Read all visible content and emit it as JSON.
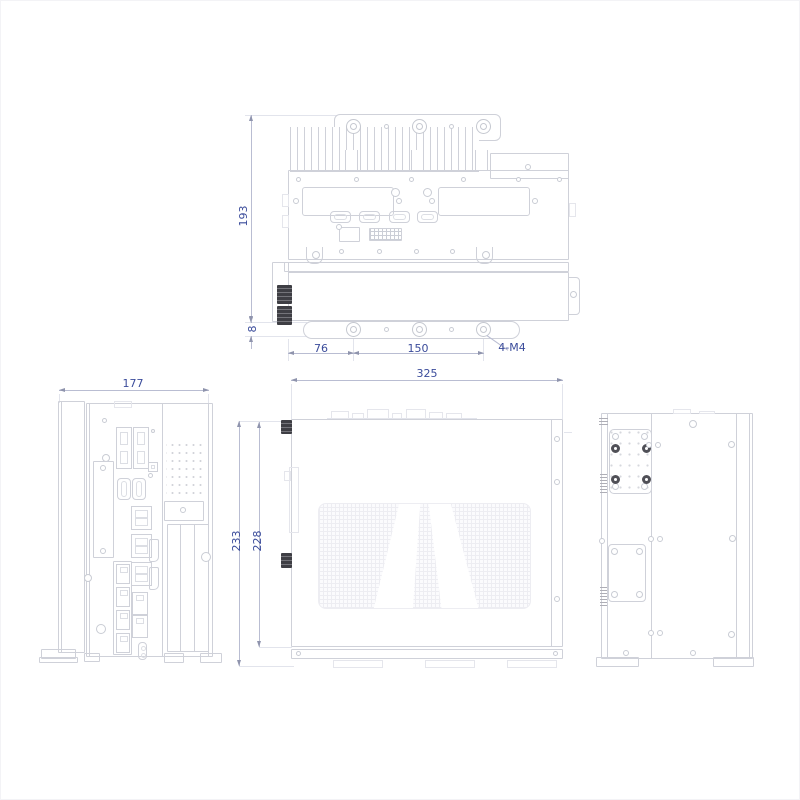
{
  "drawing": {
    "colors": {
      "background": "#ffffff",
      "outline": "#cfd1d9",
      "outline_faint": "#e5e6ec",
      "dimension_text": "#3b4c9b",
      "dimension_line": "#b9bdd2",
      "arrow": "#8f94ad",
      "dark_fitting": "#3e3e44"
    }
  },
  "views": {
    "rear": {
      "dim_height": "193",
      "dim_foot_offset": "8",
      "dim_mount_hole_left": "76",
      "dim_mount_hole_span": "150",
      "dim_mount_thread": "4-M4"
    },
    "front": {
      "dim_width": "177"
    },
    "top": {
      "dim_width": "325",
      "dim_depth_outer": "233",
      "dim_depth_inner": "228"
    }
  }
}
